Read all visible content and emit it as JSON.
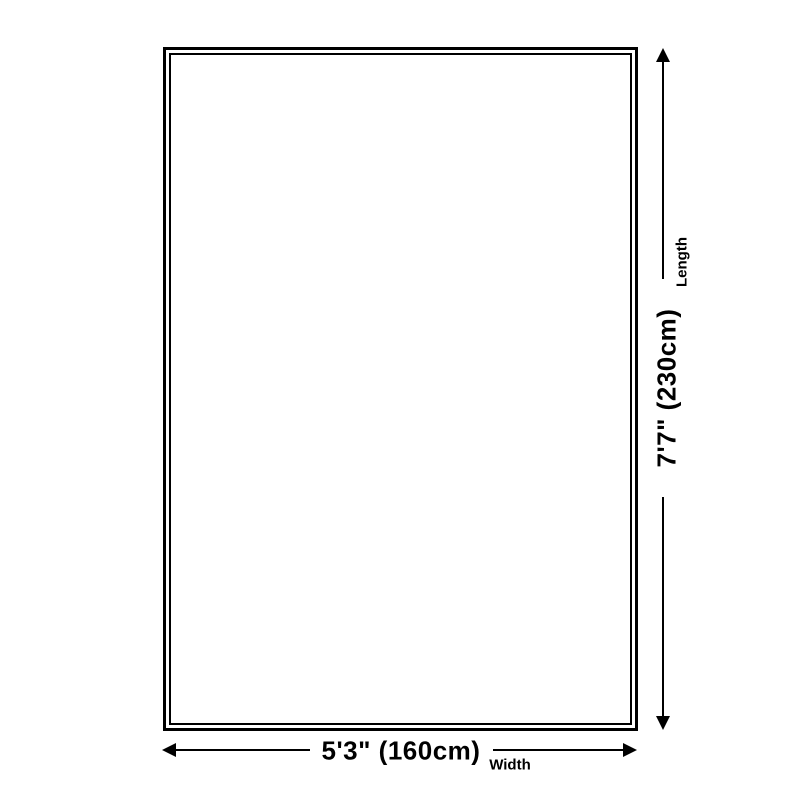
{
  "diagram": {
    "type": "product-dimension-diagram",
    "length": {
      "label": "Length",
      "value": "7'7\" (230cm)"
    },
    "width": {
      "label": "Width",
      "value": "5'3\" (160cm)"
    },
    "colors": {
      "line": "#000000",
      "background": "#ffffff"
    }
  }
}
